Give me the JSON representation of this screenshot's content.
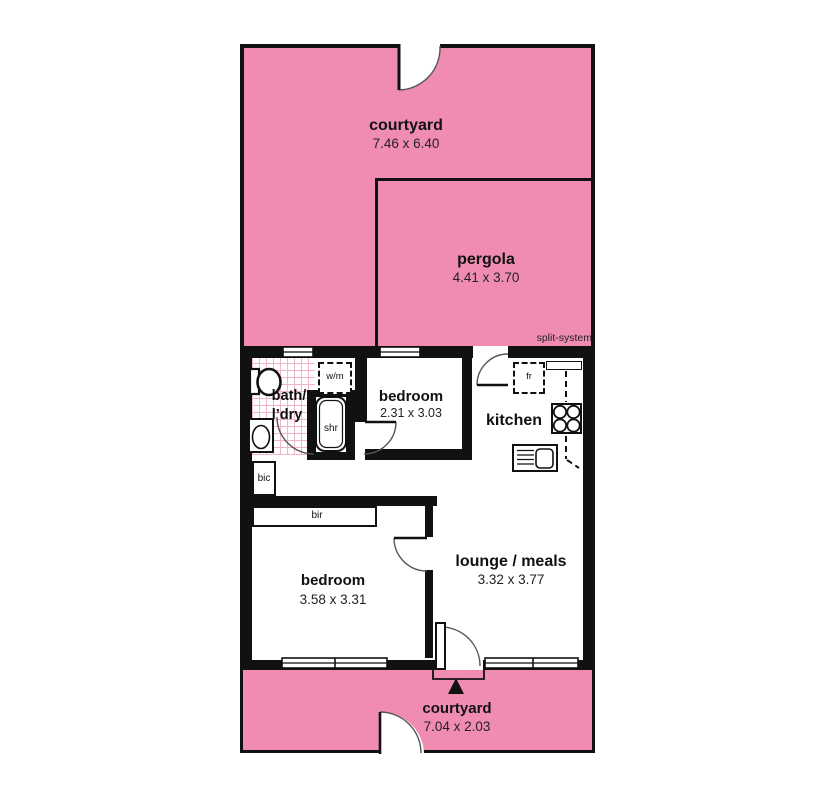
{
  "rooms": {
    "courtyard_top": {
      "name": "courtyard",
      "dims": "7.46 x 6.40"
    },
    "pergola": {
      "name": "pergola",
      "dims": "4.41 x 3.70"
    },
    "bedroom_top": {
      "name": "bedroom",
      "dims": "2.31 x 3.03"
    },
    "kitchen": {
      "name": "kitchen"
    },
    "bath": {
      "name_line1": "bath/",
      "name_line2": "l’dry"
    },
    "bedroom_bottom": {
      "name": "bedroom",
      "dims": "3.58 x 3.31"
    },
    "lounge": {
      "name": "lounge / meals",
      "dims": "3.32 x 3.77"
    },
    "courtyard_bottom": {
      "name": "courtyard",
      "dims": "7.04 x 2.03"
    }
  },
  "fixtures": {
    "washing_machine": "w/m",
    "shower": "shr",
    "built_in_cupboard": "bic",
    "built_in_robe": "bir",
    "fridge": "fr"
  },
  "annotations": {
    "split_system": "split-system"
  },
  "colors": {
    "outdoor_pink": "#f08cb2",
    "wall_black": "#111111",
    "tile_pink": "#f1b4cc"
  }
}
